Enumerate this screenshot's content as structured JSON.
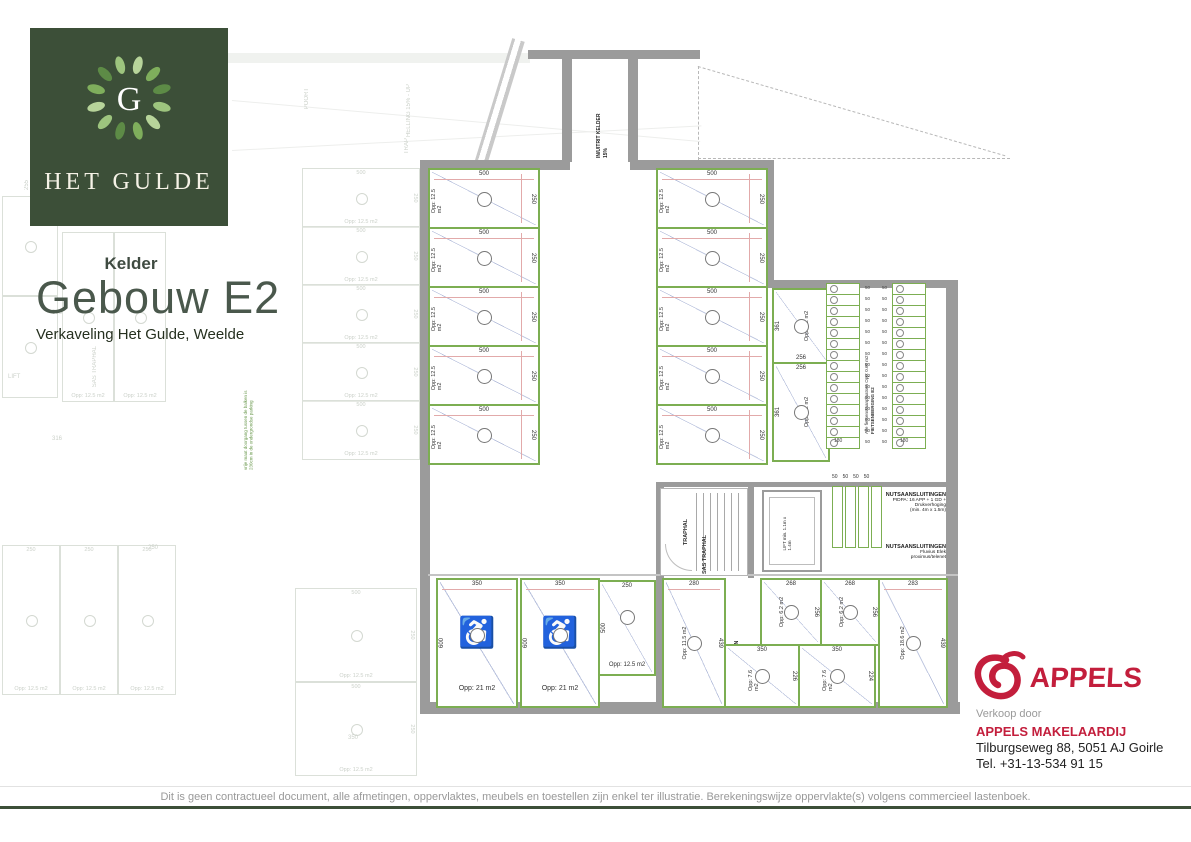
{
  "branding": {
    "monogram": "G",
    "wordmark": "Het Gulde"
  },
  "header": {
    "floor_label": "Kelder",
    "title": "Gebouw E2",
    "subtitle": "Verkaveling Het Gulde, Weelde"
  },
  "colors": {
    "brand_green": "#3c4f38",
    "accent_green": "#7cae52",
    "wall_gray": "#9b9b9b",
    "dim_red": "#e2aaaa",
    "diag_blue": "#b9c2dd",
    "appels_red": "#c31e3c"
  },
  "plan": {
    "entry": {
      "line1": "IN/UITRIT KELDER",
      "line2": "15%"
    },
    "note_green": "vrije maat doorgang tussen de balken is 230cm in de ondergrondse parking",
    "parking": {
      "left": [
        {
          "top": "500",
          "side": "250",
          "area": "Opp: 12.5 m2"
        },
        {
          "top": "500",
          "side": "250",
          "area": "Opp: 12.5 m2"
        },
        {
          "top": "500",
          "side": "250",
          "area": "Opp: 12.5 m2"
        },
        {
          "top": "500",
          "side": "250",
          "area": "Opp: 12.5 m2"
        },
        {
          "top": "500",
          "side": "250",
          "area": "Opp: 12.5 m2"
        }
      ],
      "right": [
        {
          "top": "500",
          "side": "250",
          "area": "Opp: 12.5 m2"
        },
        {
          "top": "500",
          "side": "250",
          "area": "Opp: 12.5 m2"
        },
        {
          "top": "500",
          "side": "250",
          "area": "Opp: 12.5 m2"
        },
        {
          "top": "500",
          "side": "250",
          "area": "Opp: 12.5 m2"
        },
        {
          "top": "500",
          "side": "250",
          "area": "Opp: 12.5 m2"
        }
      ]
    },
    "rooms_storage_side": {
      "room_a": {
        "side": "361",
        "bottom": "256",
        "area": "Opp: 9.2 m2"
      },
      "room_b": {
        "top": "256",
        "side": "361",
        "area": "Opp: 9.2 m2"
      }
    },
    "bike": {
      "note": "Alle fietsenstaanplaatsen Opp: 0.60 m2",
      "title": "FIETSENBERGING E2",
      "bottom_dim_left": "180",
      "bottom_dim_right": "180",
      "left_rows": [
        {
          "dim": "50"
        },
        {
          "dim": "50"
        },
        {
          "dim": "50"
        },
        {
          "dim": "50"
        },
        {
          "dim": "50"
        },
        {
          "dim": "50"
        },
        {
          "dim": "50"
        },
        {
          "dim": "50"
        },
        {
          "dim": "50"
        },
        {
          "dim": "50"
        },
        {
          "dim": "50"
        },
        {
          "dim": "50"
        },
        {
          "dim": "50"
        },
        {
          "dim": "50"
        },
        {
          "dim": "50"
        }
      ],
      "right_rows": [
        {
          "dim": "50"
        },
        {
          "dim": "50"
        },
        {
          "dim": "50"
        },
        {
          "dim": "50"
        },
        {
          "dim": "50"
        },
        {
          "dim": "50"
        },
        {
          "dim": "50"
        },
        {
          "dim": "50"
        },
        {
          "dim": "50"
        },
        {
          "dim": "50"
        },
        {
          "dim": "50"
        },
        {
          "dim": "50"
        },
        {
          "dim": "50"
        },
        {
          "dim": "50"
        },
        {
          "dim": "50"
        }
      ]
    },
    "core": {
      "stair_label": "TRAPHAL",
      "sas_label": "SAS TRAPHAL",
      "lift_label": "LIFT min. 1.1m x 1.4m",
      "stall_dims": [
        "50",
        "50",
        "50",
        "50"
      ],
      "utility_1": {
        "title": "NUTSAANSLUITINGEN",
        "line1": "PIDPA: 16 APP + 1 GD + Drukverhoging",
        "line2": "(min. 4m x 1.5m)"
      },
      "utility_2": {
        "title": "NUTSAANSLUITINGEN",
        "line1": "Fluvius Elek",
        "line2": "proximus/telenet"
      }
    },
    "bottom": {
      "hc_spots": [
        {
          "top": "350",
          "side": "600",
          "area": "Opp: 21 m2"
        },
        {
          "top": "350",
          "side": "600",
          "area": "Opp: 21 m2"
        }
      ],
      "spot": {
        "top": "250",
        "side": "500",
        "area": "Opp: 12.5 m2"
      },
      "room_left": {
        "top": "280",
        "side": "439",
        "area": "Opp: 11.5 m2"
      },
      "corridor_label": "GANG BERGINGEN",
      "rooms_small": [
        {
          "top": "268",
          "side": "256",
          "area": "Opp: 6.2 m2"
        },
        {
          "top": "268",
          "side": "256",
          "area": "Opp: 6.2 m2"
        }
      ],
      "room_right": {
        "top": "283",
        "side": "439",
        "area": "Opp: 18.6 m2"
      },
      "storage_rooms": [
        {
          "top": "350",
          "side": "226",
          "area": "Opp: 7.6 m2"
        },
        {
          "top": "350",
          "side": "224",
          "area": "Opp: 7.6 m2"
        }
      ]
    }
  },
  "background": {
    "labels": [
      {
        "text": "150",
        "x": 38,
        "y": 160
      },
      {
        "text": "255",
        "x": 24,
        "y": 180,
        "vert": true
      },
      {
        "text": "316",
        "x": 52,
        "y": 310
      },
      {
        "text": "316",
        "x": 52,
        "y": 436
      },
      {
        "text": "SAS TRAPHAL",
        "x": 92,
        "y": 346,
        "vert": true
      },
      {
        "text": "LIFT",
        "x": 8,
        "y": 374
      },
      {
        "text": "POORT",
        "x": 304,
        "y": 88,
        "vert": true
      },
      {
        "text": "HELLING 15% - UP",
        "x": 406,
        "y": 84,
        "vert": true
      },
      {
        "text": "TRAP",
        "x": 404,
        "y": 138,
        "vert": true
      },
      {
        "text": "350",
        "x": 348,
        "y": 735
      },
      {
        "text": "250",
        "x": 148,
        "y": 545
      }
    ],
    "cells": [
      {
        "x": 2,
        "y": 196,
        "w": 54,
        "h": 98
      },
      {
        "x": 2,
        "y": 296,
        "w": 54,
        "h": 100
      },
      {
        "x": 62,
        "y": 232,
        "w": 50,
        "h": 168,
        "area": "Opp: 12.5 m2"
      },
      {
        "x": 114,
        "y": 232,
        "w": 50,
        "h": 168,
        "area": "Opp: 12.5 m2"
      },
      {
        "x": 302,
        "y": 168,
        "w": 116,
        "h": 58,
        "top": "500",
        "side": "250",
        "area": "Opp: 12.5 m2"
      },
      {
        "x": 302,
        "y": 226,
        "w": 116,
        "h": 58,
        "top": "500",
        "side": "250",
        "area": "Opp: 12.5 m2"
      },
      {
        "x": 302,
        "y": 284,
        "w": 116,
        "h": 58,
        "top": "500",
        "side": "250",
        "area": "Opp: 12.5 m2"
      },
      {
        "x": 302,
        "y": 342,
        "w": 116,
        "h": 58,
        "top": "500",
        "side": "250",
        "area": "Opp: 12.5 m2"
      },
      {
        "x": 302,
        "y": 400,
        "w": 116,
        "h": 58,
        "top": "500",
        "side": "250",
        "area": "Opp: 12.5 m2"
      },
      {
        "x": 2,
        "y": 545,
        "w": 56,
        "h": 148,
        "top": "250",
        "area": "Opp: 12.5 m2"
      },
      {
        "x": 60,
        "y": 545,
        "w": 56,
        "h": 148,
        "top": "250",
        "area": "Opp: 12.5 m2"
      },
      {
        "x": 118,
        "y": 545,
        "w": 56,
        "h": 148,
        "top": "250",
        "area": "Opp: 12.5 m2"
      },
      {
        "x": 295,
        "y": 588,
        "w": 120,
        "h": 92,
        "top": "500",
        "side": "250",
        "area": "Opp: 12.5 m2"
      },
      {
        "x": 295,
        "y": 682,
        "w": 120,
        "h": 92,
        "top": "500",
        "side": "250",
        "area": "Opp: 12.5 m2"
      }
    ]
  },
  "agency": {
    "logo_text": "APPELS",
    "intro": "Verkoop door",
    "name": "APPELS MAKELAARDIJ",
    "address": "Tilburgseweg 88, 5051 AJ Goirle",
    "phone": "Tel. +31-13-534 91 15"
  },
  "footer": {
    "disclaimer": "Dit is geen contractueel document, alle afmetingen, oppervlaktes, meubels en toestellen zijn enkel ter illustratie. Berekeningswijze oppervlakte(s) volgens commercieel lastenboek."
  }
}
